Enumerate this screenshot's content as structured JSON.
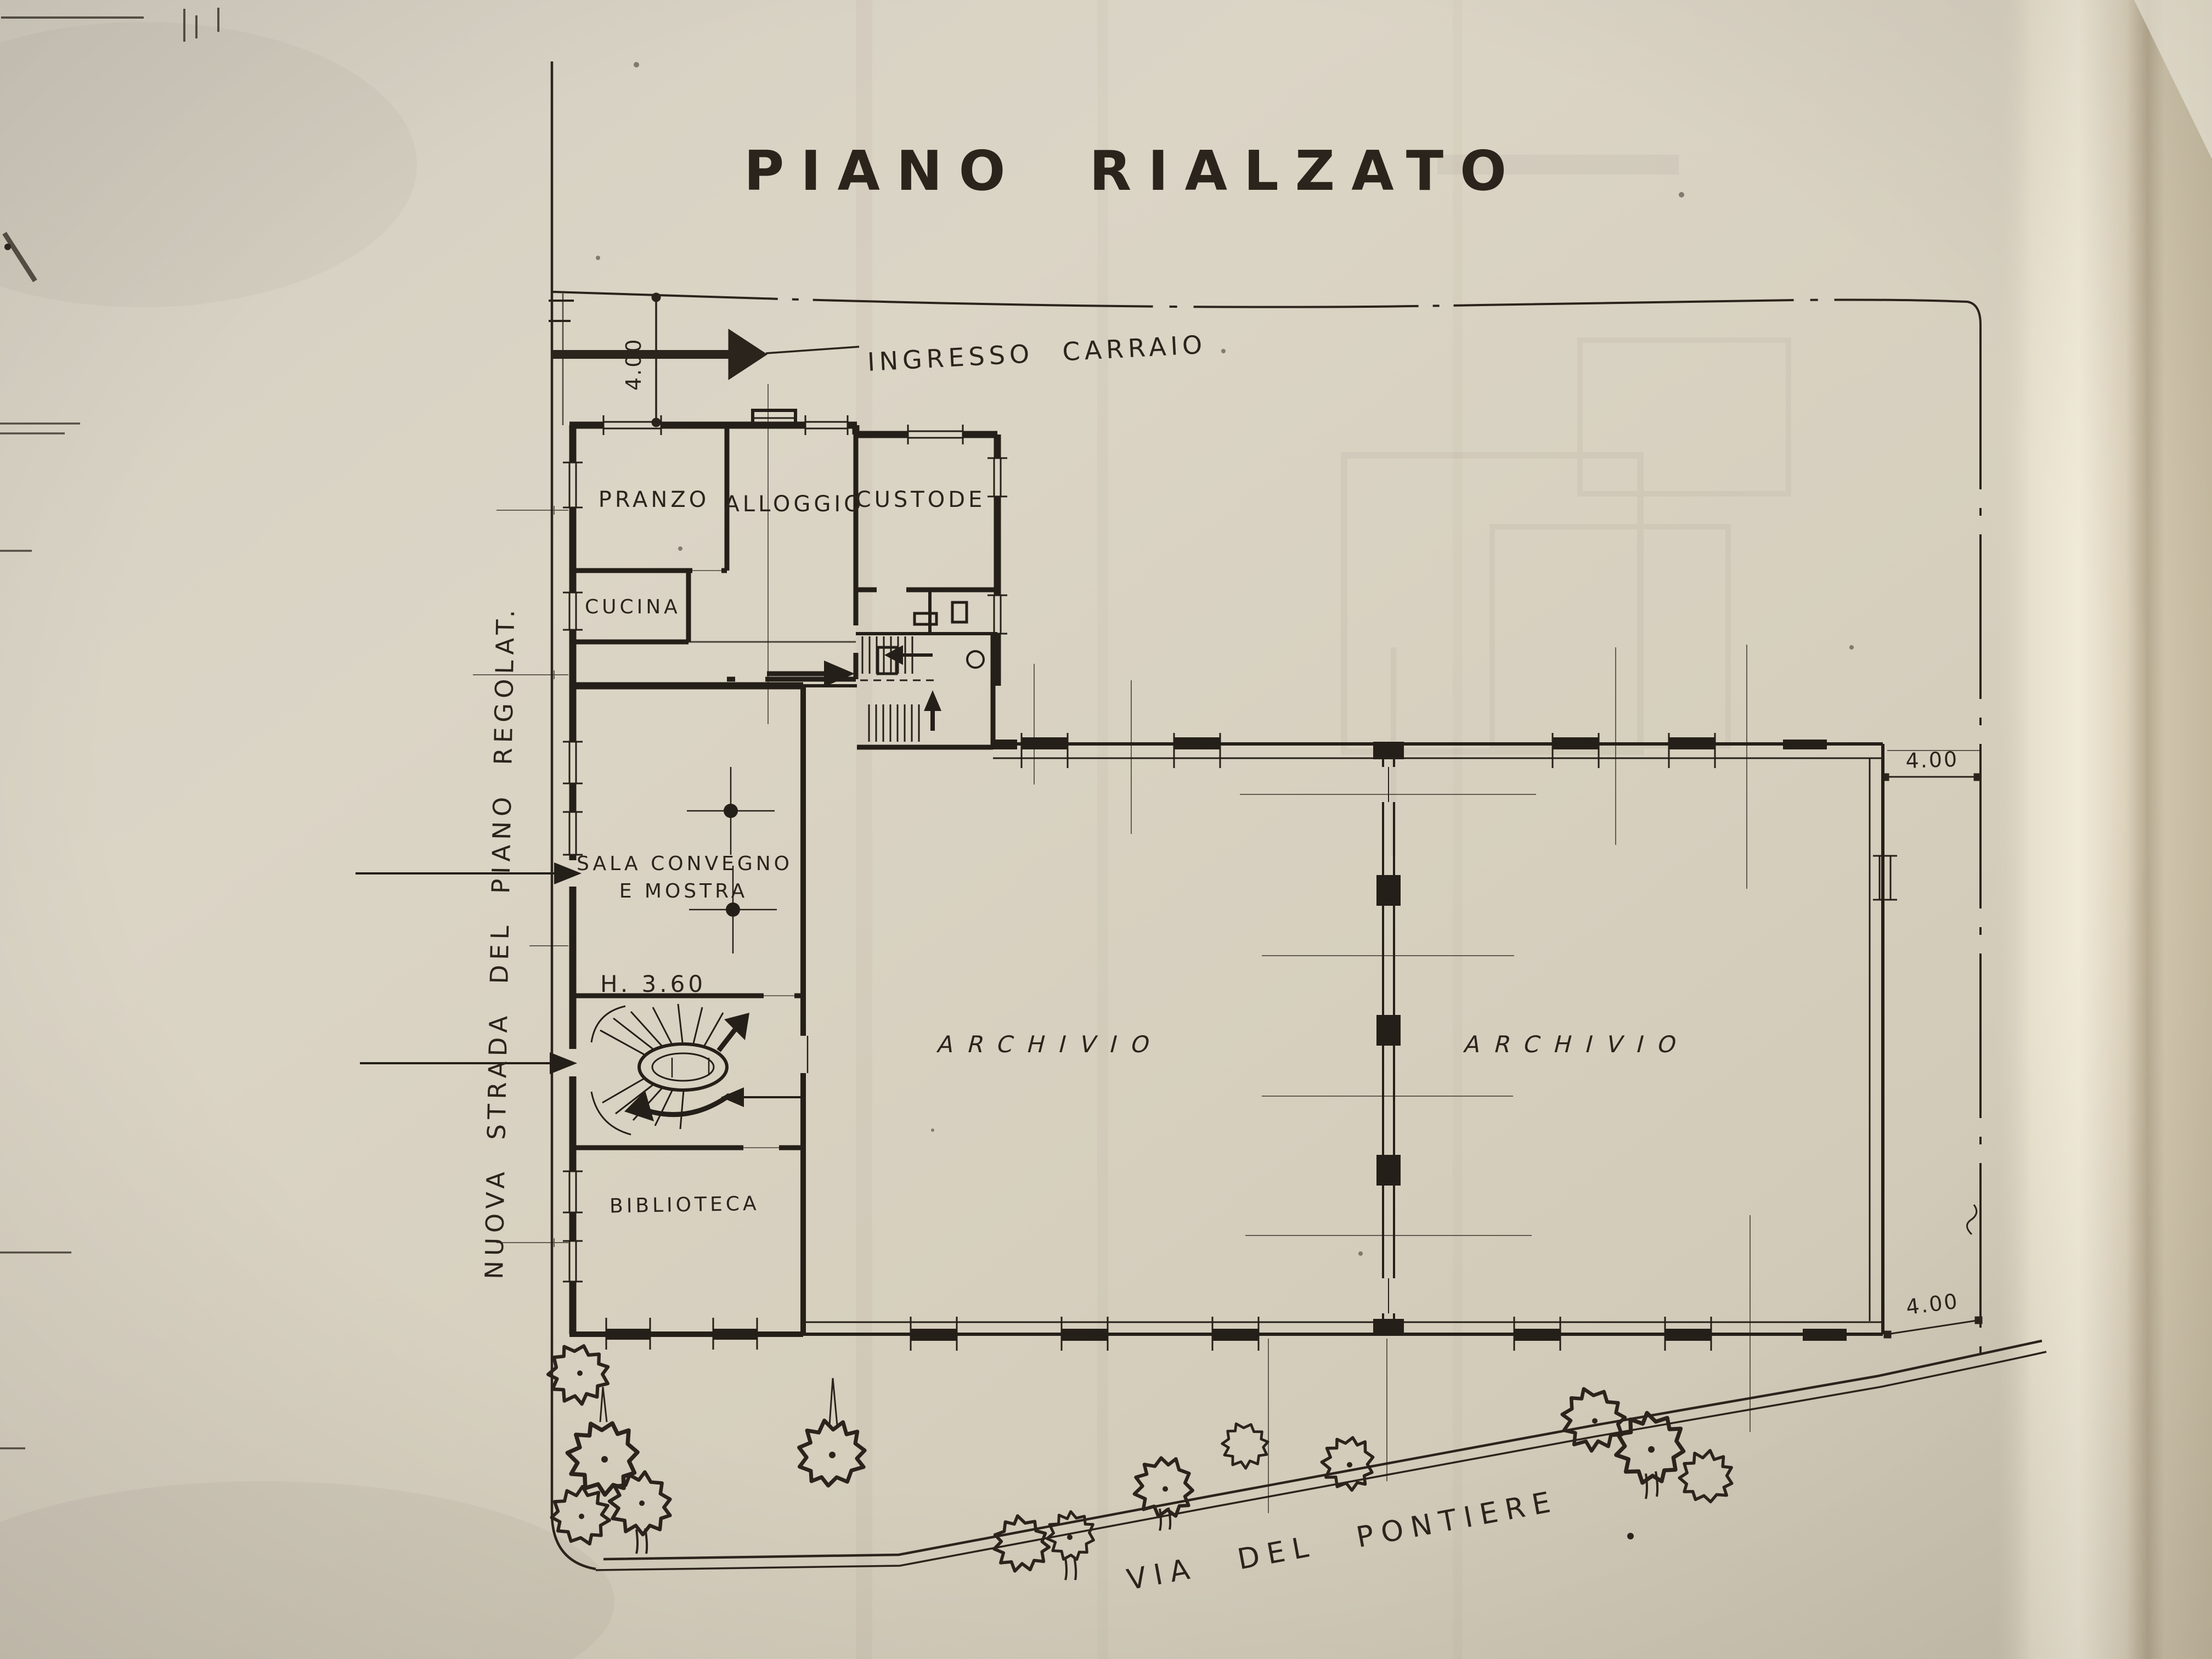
{
  "title": "PIANO RIALZATO",
  "site": {
    "street_left": "NUOVA STRADA DEL PIANO REGOLAT.",
    "street_bottom": "VIA DEL PONTIERE",
    "entrance_label": "INGRESSO CARRAIO"
  },
  "rooms": {
    "pranzo": "PRANZO",
    "alloggio": "ALLOGGIO",
    "custode": "CUSTODE",
    "cucina": "CUCINA",
    "sala_line1": "SALA CONVEGNO",
    "sala_line2": "E MOSTRA",
    "height_note": "H. 3.60",
    "archivio_left": "ARCHIVIO",
    "archivio_right": "ARCHIVIO",
    "biblioteca": "BIBLIOTECA"
  },
  "dimensions": {
    "top_left": "4.00",
    "right_upper": "4.00",
    "right_lower": "4.00"
  },
  "colors": {
    "ink": "#2a241c",
    "paper": "#d8d1c1"
  }
}
